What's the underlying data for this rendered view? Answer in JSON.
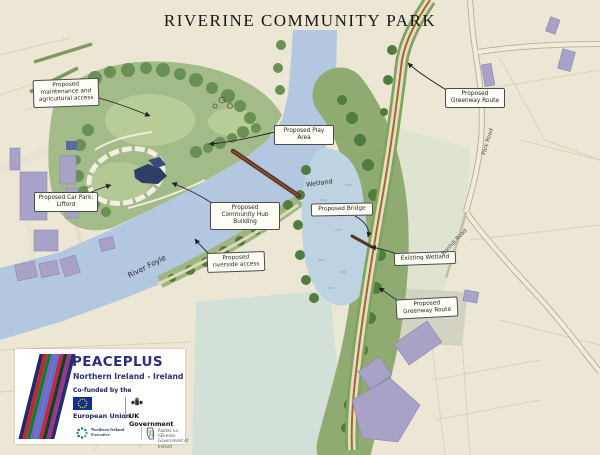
{
  "title": "RIVERINE COMMUNITY PARK",
  "map_labels": {
    "maintenance_access": "Proposed maintenance and agricultural access",
    "greenway_route_top": "Proposed Greenway Route",
    "play_area": "Proposed Play Area",
    "car_park": "Proposed Car Park: Lifford",
    "community_hub": "Proposed Community Hub Building",
    "wetland": "Wetland",
    "proposed_bridge": "Proposed Bridge",
    "riverside_access": "Proposed riverside access",
    "existing_wetland": "Existing Wetland",
    "greenway_route_bottom": "Proposed Greenway Route",
    "river_foyle": "River Foyle",
    "park_road": "Park Road",
    "bonhill_road": "Bonhill Road"
  },
  "funding_block": {
    "brand": "PEACEPLUS",
    "programme_area": "Northern Ireland - Ireland",
    "cofunded_by": "Co-funded by the",
    "european_union": "European Union",
    "uk_government": "UK Government",
    "ni_executive": "Northern Ireland Executive",
    "govt_ireland_irish": "Rialtas na hÉireann",
    "govt_ireland": "Government of Ireland"
  },
  "colors": {
    "background": "#ece7d5",
    "water": "#b4c7e0",
    "parkland": "#a3bb88",
    "greenway_line": "#a4682f",
    "building_purple": "#a7a2c6",
    "hub_building_navy": "#30406b",
    "bridge_brown": "#5a3322",
    "brand_blue": "#29307c",
    "eu_flag_blue": "#003399",
    "eu_star_yellow": "#ffcc00"
  }
}
